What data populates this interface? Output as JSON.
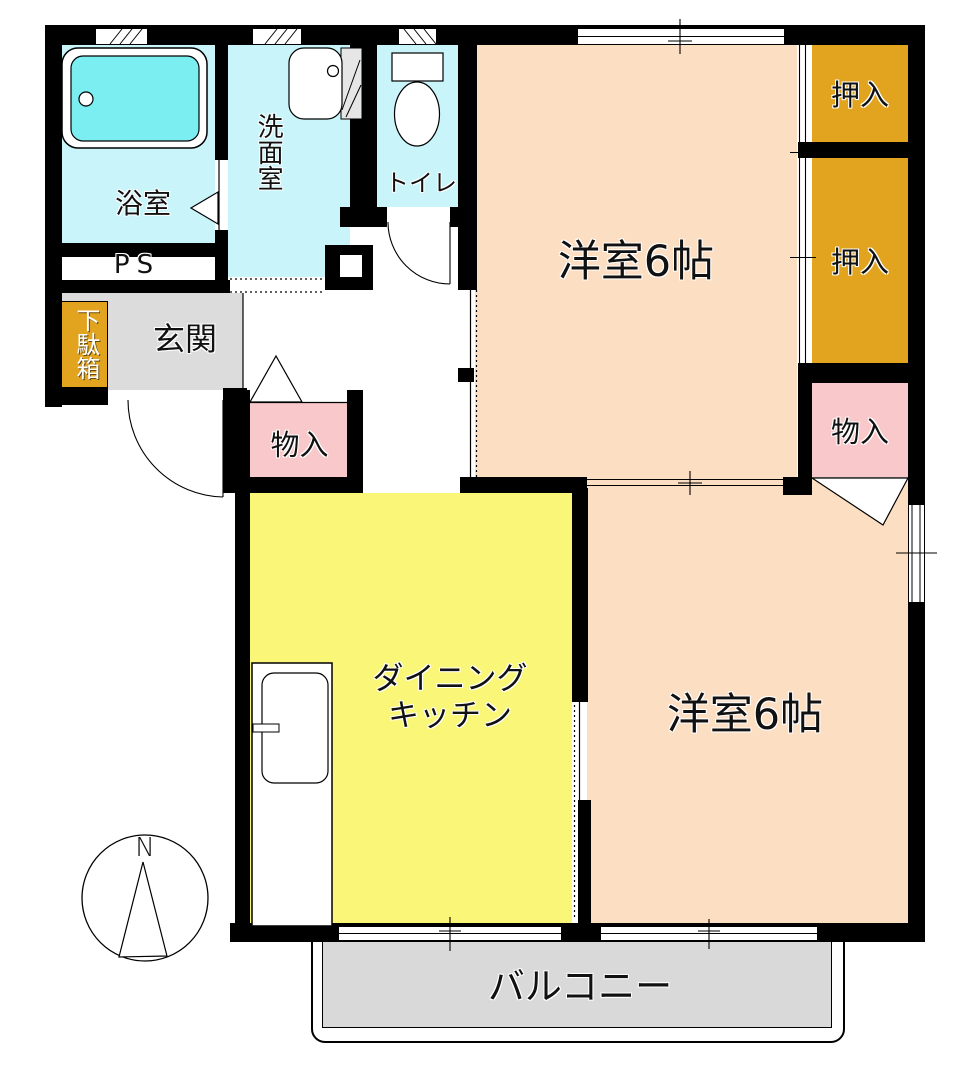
{
  "colors": {
    "wall": "#000000",
    "cyan-floor": "#c9f4f9",
    "tub-cyan": "#7beef2",
    "peach": "#fcdfc2",
    "closet-orange": "#e2a41e",
    "pink": "#f9c8ca",
    "dk-yellow": "#faf678",
    "genkan-gray": "#dcdcdc",
    "balcony-gray": "#d9d9d9"
  },
  "rooms": {
    "bath": {
      "label": "浴室"
    },
    "washroom": {
      "label": "洗面室"
    },
    "toilet": {
      "label": "トイレ"
    },
    "pipe_space": {
      "label": "PS"
    },
    "shoe_cabinet": {
      "label": "下駄箱"
    },
    "entrance": {
      "label": "玄関"
    },
    "hall_storage": {
      "label": "物入"
    },
    "western_room_top": {
      "label": "洋室6帖"
    },
    "closet_top": {
      "label": "押入"
    },
    "closet_middle": {
      "label": "押入"
    },
    "right_storage": {
      "label": "物入"
    },
    "dining_kitchen": {
      "label_line1": "ダイニング",
      "label_line2": "キッチン"
    },
    "western_room_bottom": {
      "label": "洋室6帖"
    },
    "balcony": {
      "label": "バルコニー"
    }
  },
  "compass": {
    "north_label": "N"
  }
}
